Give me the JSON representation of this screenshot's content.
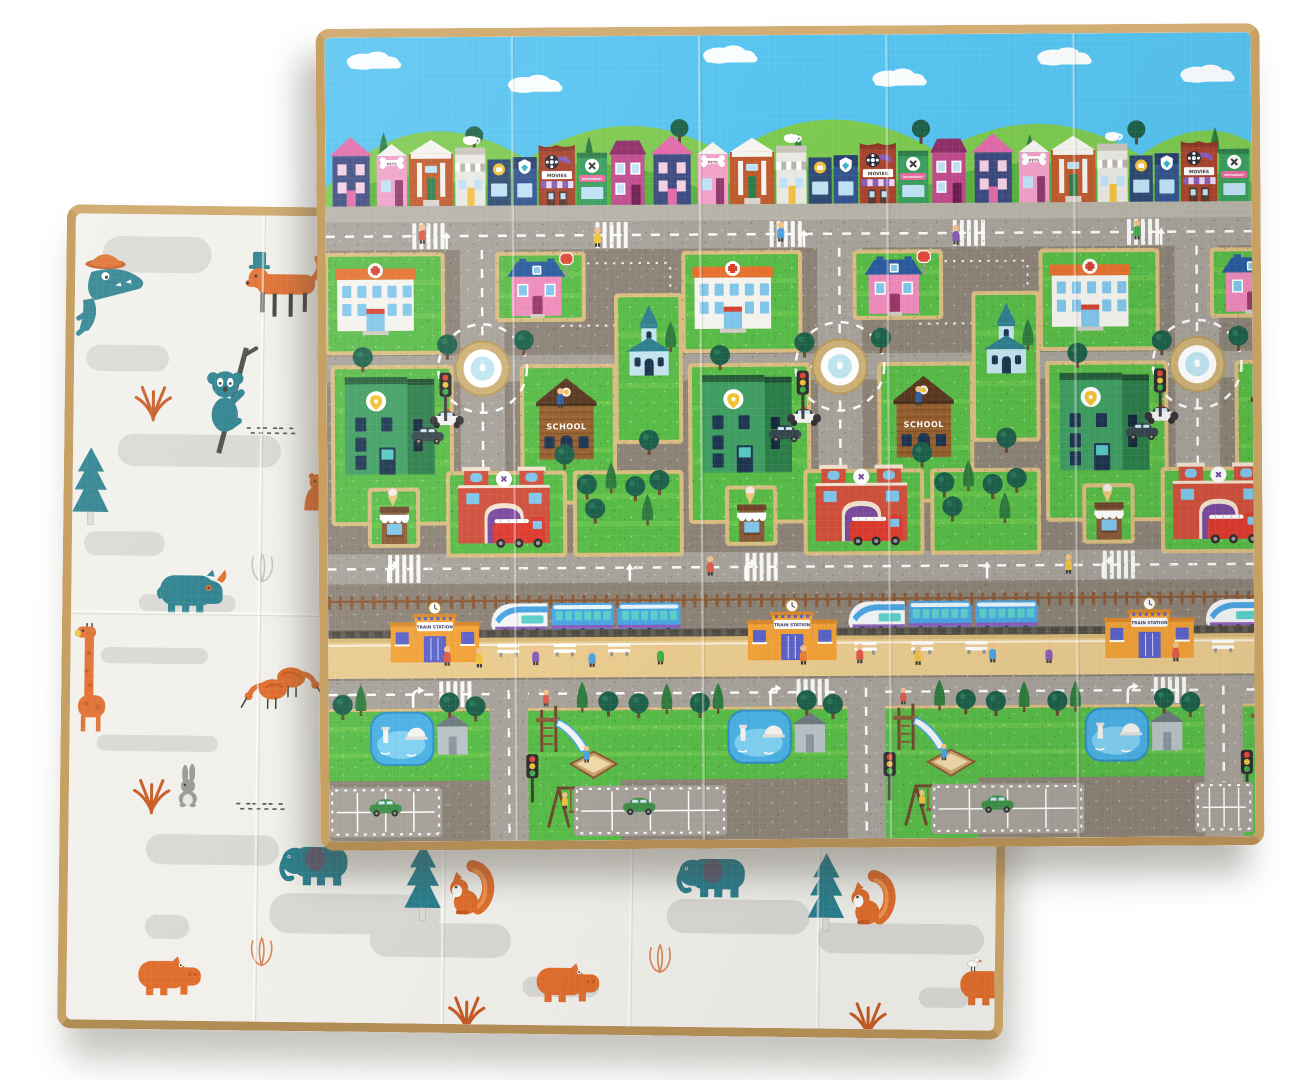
{
  "image": {
    "subject": "Double-sided foldable baby play mat: city traffic side in front, animal pattern side behind",
    "background_color": "#ffffff",
    "mat_border_color": "#c7a164"
  },
  "city_side": {
    "name": "city-traffic-play-mat",
    "labels": {
      "pets_shop_sign": "PETS",
      "movies_sign": "MOVIES",
      "restaurant_sign": "RESTAURANT",
      "school_sign": "SCHOOL",
      "train_station_sign": "TRAIN STATION"
    },
    "colors": {
      "sky": "#55c3f0",
      "hill_back": "#7cc94e",
      "hill_front": "#58b23e",
      "tree_dark": "#1d6049",
      "tree_mid": "#2f7b3d",
      "sidewalk": "#b7b2a8",
      "block": "#8c8276",
      "road": "#a6a199",
      "curb": "#d9bc80",
      "grass": "#57bb46",
      "grass_light": "#72ca4f",
      "ring": "#cdb176",
      "ring_edge": "#b79a5c",
      "pool": "#bfe6f2",
      "hospital_wall": "#f5f3ee",
      "hospital_roof": "#e5702d",
      "cross_red": "#d6402f",
      "window_blue": "#7fc6ea",
      "window_navy": "#1d3550",
      "pink_wall": "#ee8aba",
      "blue_roof": "#2a5a9e",
      "door_magenta": "#973666",
      "school_wall": "#96602f",
      "school_dark": "#7c4b24",
      "school_roof": "#5a3820",
      "green_front": "#3f9e62",
      "green_side": "#2c7d4a",
      "pin_yellow": "#f2c230",
      "church_wall": "#c3e4ef",
      "church_roof": "#2e7f8e",
      "fire_wall": "#d0503c",
      "fire_trim": "#f2e3d0",
      "fire_door": "#7a4a9e",
      "truck_red": "#dd3b2f",
      "kiosk_brown": "#8a5a38",
      "cone": "#e8c87a",
      "station_orange": "#f2a136",
      "station_roof": "#d8882a",
      "station_door": "#5a62c8",
      "sign_text": "#3a3a66",
      "train_blue": "#4aa5e2",
      "train_window": "#5ad0c8",
      "train_stripe": "#8a5bb8",
      "fence": "#8a5a38",
      "rail": "#615c52",
      "platform": "#e9cb8e",
      "platform_edge": "#d8b978",
      "skin": "#f2c18c",
      "car_green": "#3f8f4a",
      "light_red": "#e04838",
      "light_amber": "#f0c040",
      "light_green": "#3fae4a"
    },
    "shop_colors": {
      "navy": "#3c4a80",
      "pink_roof": "#e06aa8",
      "pets": "#f0a0c8",
      "bank": "#bf5a2e",
      "bank_door": "#2e7d4a",
      "cafe": "#2e4a72",
      "flag": "#33548e",
      "movies": "#a8432e",
      "movies_trim": "#8e3626",
      "awning_purple": "#8a5bb8",
      "awning_lav": "#e8d8f5",
      "restaurant": "#3a9e5e",
      "restaurant_trim": "#2e7d4a",
      "ribbon": "#e86a9e",
      "magenta": "#c04a8e",
      "magenta_roof": "#8e2f68",
      "yellow": "#f0c040"
    },
    "layout": {
      "tiles": [
        0,
        355,
        710
      ],
      "shops": {
        "sequence": [
          "navy_house",
          "pets_shop",
          "bank",
          "bakery",
          "cafe",
          "flag_shop",
          "movies",
          "restaurant",
          "magenta_house"
        ],
        "gap": 2,
        "baseline": 168,
        "start_x": 2,
        "repeats": 3
      },
      "clouds": [
        [
          38,
          16
        ],
        [
          198,
          40
        ],
        [
          392,
          12
        ],
        [
          560,
          36
        ],
        [
          724,
          16
        ],
        [
          866,
          34
        ]
      ],
      "hill_trees": [
        [
          58,
          112,
          "c"
        ],
        [
          148,
          98,
          "r"
        ],
        [
          262,
          118,
          "c"
        ],
        [
          352,
          92,
          "r"
        ],
        [
          470,
          116,
          "c"
        ],
        [
          592,
          94,
          "r"
        ],
        [
          700,
          118,
          "c"
        ],
        [
          806,
          96,
          "r"
        ],
        [
          884,
          112,
          "c"
        ]
      ],
      "roads": {
        "top": [
          184,
          28
        ],
        "mid": [
          514,
          30
        ],
        "bottom": [
          640,
          28
        ],
        "v_main": [
          133,
          44,
          212,
          302
        ],
        "v_bottom": [
          160,
          38,
          650,
          150
        ],
        "connector": [
          155,
          317,
          357,
          26
        ]
      },
      "lots": {
        "hospital": [
          2,
          218,
          112,
          94
        ],
        "pink": [
          172,
          218,
          82,
          62
        ],
        "green_b": [
          8,
          330,
          114,
          152
        ],
        "school": [
          196,
          330,
          88,
          132
        ],
        "church": [
          290,
          260,
          60,
          142
        ],
        "fire": [
          122,
          436,
          112,
          78
        ],
        "park": [
          248,
          436,
          102,
          78
        ],
        "kiosk": [
          44,
          452,
          44,
          52
        ]
      },
      "tile_elements": {
        "hospital": [
          9,
          224
        ],
        "pink_house": [
          180,
          221
        ],
        "roundabout": [
          155,
          330
        ],
        "school": [
          208,
          340
        ],
        "green_building": [
          18,
          338
        ],
        "church": [
          298,
          268
        ],
        "fire_station": [
          130,
          428
        ],
        "kiosk": [
          50,
          448
        ],
        "station": [
          62,
          562
        ],
        "pond": [
          42,
          672
        ],
        "shed": [
          106,
          674
        ],
        "slide": [
          200,
          662
        ],
        "sandbox": [
          240,
          712
        ],
        "swing": [
          214,
          742
        ],
        "traffic_light_bottom": [
          196,
          714
        ],
        "stop_sign": [
          232,
          214
        ],
        "traffic_light_mid": [
          112,
          334
        ],
        "police_car": [
          102,
          372
        ],
        "dark_car": [
          84,
          388
        ]
      },
      "park_trees": [
        [
          258,
          446,
          "r"
        ],
        [
          282,
          440,
          "c"
        ],
        [
          306,
          448,
          "r"
        ],
        [
          330,
          442,
          "r"
        ],
        [
          266,
          470,
          "r"
        ],
        [
          318,
          472,
          "c"
        ]
      ],
      "main_trees": [
        [
          120,
          306,
          "r"
        ],
        [
          196,
          302,
          "r"
        ],
        [
          320,
          402,
          "r"
        ],
        [
          236,
          416,
          "r"
        ],
        [
          342,
          300,
          "c"
        ],
        [
          36,
          318,
          "r"
        ]
      ],
      "bottom_trees": [
        [
          14,
          664,
          "r"
        ],
        [
          32,
          660,
          "c"
        ],
        [
          120,
          662,
          "r"
        ],
        [
          146,
          666,
          "r"
        ],
        [
          252,
          658,
          "c"
        ],
        [
          278,
          662,
          "r"
        ],
        [
          308,
          664,
          "r"
        ],
        [
          336,
          660,
          "c"
        ]
      ],
      "trains": [
        [
          160,
          560
        ],
        [
          515,
          560
        ],
        [
          870,
          560
        ]
      ],
      "train_band": {
        "fence_y": 556,
        "rail_y": 590,
        "platform": [
          598,
          40
        ]
      },
      "parking_lots": [
        [
          0,
          746,
          112,
          50
        ],
        [
          243,
          746,
          152,
          50
        ],
        [
          598,
          746,
          152,
          50
        ],
        [
          860,
          746,
          58,
          50
        ]
      ],
      "green_cars": [
        [
          40,
          758
        ],
        [
          292,
          758
        ],
        [
          648,
          758
        ]
      ],
      "benches_platform": [
        [
          168,
          604
        ],
        [
          224,
          604
        ],
        [
          278,
          604
        ]
      ],
      "platform_people": [
        [
          118,
          606,
          "#e05a4a"
        ],
        [
          150,
          608,
          "#f0c040"
        ],
        [
          206,
          606,
          "#8a5bb8"
        ],
        [
          262,
          608,
          "#4aa3e2"
        ],
        [
          330,
          606,
          "#3fae4a"
        ],
        [
          472,
          607,
          "#e87f3a"
        ],
        [
          528,
          606,
          "#e05a4a"
        ],
        [
          586,
          608,
          "#f0c040"
        ],
        [
          660,
          606,
          "#4aa3e2"
        ],
        [
          716,
          607,
          "#8a5bb8"
        ],
        [
          842,
          606,
          "#e05a4a"
        ]
      ],
      "street_people": [
        [
          96,
          186,
          "#e05a4a"
        ],
        [
          270,
          190,
          "#f0c040"
        ],
        [
          452,
          186,
          "#4aa3e2"
        ],
        [
          626,
          190,
          "#8a5bb8"
        ],
        [
          806,
          186,
          "#3fae4a"
        ],
        [
          232,
          350,
          "#2e5da8"
        ],
        [
          588,
          350,
          "#2e5da8"
        ],
        [
          380,
          518,
          "#e05a4a"
        ],
        [
          736,
          518,
          "#f0c040"
        ]
      ],
      "playground_people": [
        [
          216,
          650,
          "#e05a4a"
        ],
        [
          256,
          706,
          "#4aa3e2"
        ],
        [
          234,
          752,
          "#f0c040"
        ]
      ],
      "crosswalks_top": [
        86,
        268
      ],
      "crosswalk_mid": [
        60
      ],
      "crosswalk_bottom": [
        110
      ],
      "arrows": [
        [
          120,
          198,
          "s"
        ],
        [
          60,
          529,
          "t"
        ],
        [
          300,
          529,
          "s"
        ],
        [
          84,
          654,
          "t"
        ]
      ],
      "guide_blocks": [
        [
          230,
          226,
          112,
          62
        ]
      ],
      "fold_lines_vertical": [
        186,
        372,
        558,
        744
      ]
    }
  },
  "animal_side": {
    "name": "animal-pattern-play-mat",
    "colors": {
      "base": "#f1f0eb",
      "blob": "#d9d8d4",
      "teal": "#2a7f8e",
      "orange": "#e06d2c",
      "orange_deep": "#c65a22",
      "gray": "#9b9995",
      "branch": "#4a4a44",
      "dark": "#3f3f3a",
      "outline_warm": "#d8855a",
      "outline_gray": "#c6c4bd"
    },
    "blobs": [
      [
        27,
        22,
        108,
        36
      ],
      [
        398,
        94,
        240,
        52
      ],
      [
        12,
        130,
        82,
        26
      ],
      [
        44,
        218,
        162,
        32
      ],
      [
        12,
        315,
        80,
        24
      ],
      [
        67,
        377,
        96,
        17
      ],
      [
        30,
        430,
        106,
        16
      ],
      [
        27,
        517,
        120,
        16
      ],
      [
        77,
        615,
        132,
        30
      ],
      [
        200,
        672,
        170,
        40
      ],
      [
        300,
        700,
        140,
        34
      ],
      [
        77,
        695,
        44,
        24
      ],
      [
        452,
        752,
        76,
        20
      ],
      [
        594,
        673,
        142,
        34
      ],
      [
        744,
        695,
        165,
        30
      ],
      [
        845,
        758,
        50,
        20
      ]
    ],
    "animals": [
      {
        "type": "crocodile",
        "x": 0,
        "y": 34
      },
      {
        "type": "dog",
        "x": 166,
        "y": 36
      },
      {
        "type": "koala",
        "x": 126,
        "y": 136
      },
      {
        "type": "fern",
        "x": 62,
        "y": 168
      },
      {
        "type": "speckles",
        "x": 172,
        "y": 210
      },
      {
        "type": "pine",
        "x": 2,
        "y": 232
      },
      {
        "type": "bear",
        "x": 226,
        "y": 254
      },
      {
        "type": "rhino",
        "x": 86,
        "y": 348
      },
      {
        "type": "tulip",
        "x": 174,
        "y": 335,
        "warm": false
      },
      {
        "type": "giraffe",
        "x": 2,
        "y": 406
      },
      {
        "type": "ibis",
        "x": 168,
        "y": 450
      },
      {
        "type": "ibis",
        "x": 252,
        "y": 438,
        "flip": true
      },
      {
        "type": "rabbit",
        "x": 105,
        "y": 546
      },
      {
        "type": "fern",
        "x": 65,
        "y": 558
      },
      {
        "type": "speckles",
        "x": 166,
        "y": 583
      },
      {
        "type": "elephant",
        "x": 211,
        "y": 618
      },
      {
        "type": "tulip",
        "x": 178,
        "y": 716,
        "warm": true
      },
      {
        "type": "pine",
        "x": 336,
        "y": 621
      },
      {
        "type": "squirrel",
        "x": 373,
        "y": 633
      },
      {
        "type": "hippo",
        "x": 71,
        "y": 733
      },
      {
        "type": "fern",
        "x": 380,
        "y": 770
      },
      {
        "type": "hippo",
        "x": 466,
        "y": 735
      },
      {
        "type": "tulip",
        "x": 573,
        "y": 718,
        "warm": true
      },
      {
        "type": "elephant",
        "x": 605,
        "y": 625
      },
      {
        "type": "pine",
        "x": 736,
        "y": 626
      },
      {
        "type": "squirrel",
        "x": 771,
        "y": 638
      },
      {
        "type": "fern",
        "x": 778,
        "y": 771
      },
      {
        "type": "hippo",
        "x": 886,
        "y": 733
      },
      {
        "type": "bird",
        "x": 893,
        "y": 726
      }
    ],
    "fold_lines": {
      "vertical": [
        186,
        372,
        558,
        744
      ],
      "horizontal": [
        395
      ]
    }
  }
}
